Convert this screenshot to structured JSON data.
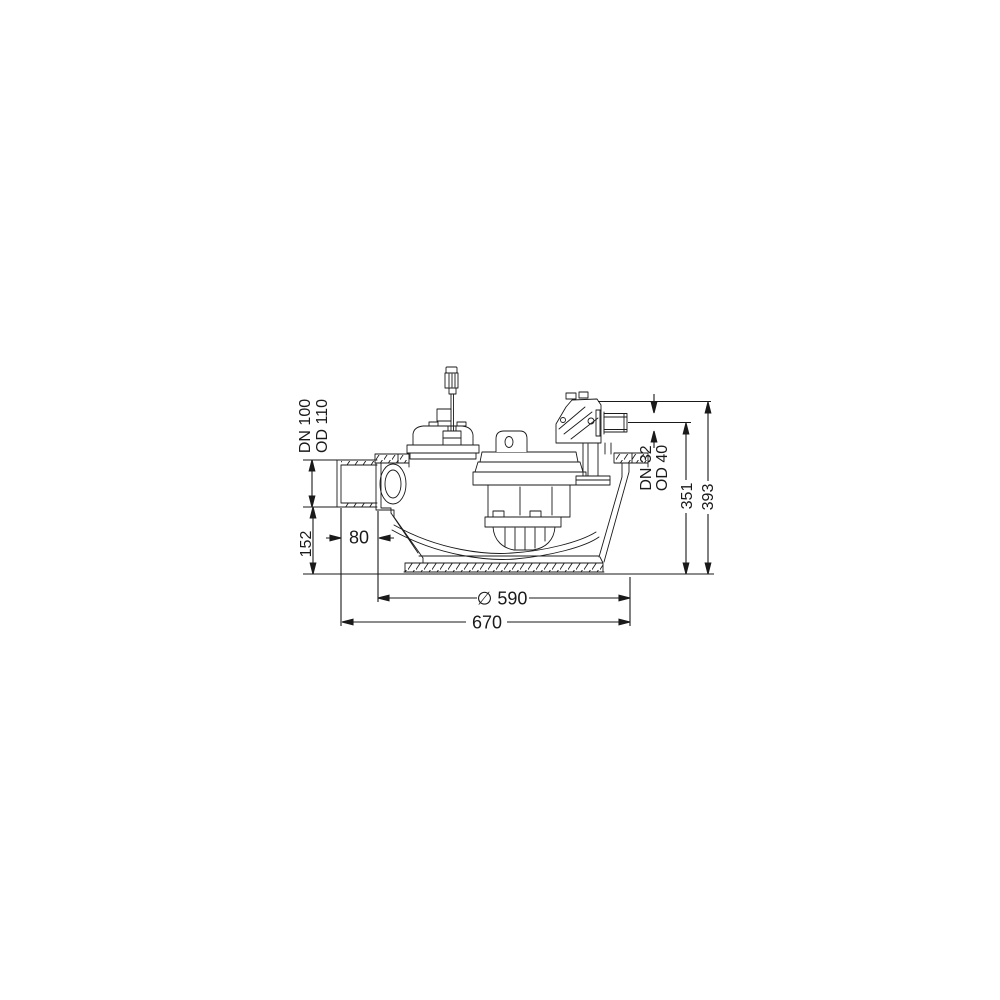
{
  "drawing": {
    "line_color": "#1a1a1a",
    "background": "#ffffff",
    "labels": {
      "inlet_dn": "DN 100",
      "inlet_od": "OD 110",
      "inlet_invert_height": "152",
      "inlet_offset": "80",
      "outlet_dn": "DN 32",
      "outlet_od": "OD 40",
      "outlet_center_height": "351",
      "overall_height": "393",
      "base_diameter": "∅ 590",
      "overall_width": "670"
    }
  }
}
